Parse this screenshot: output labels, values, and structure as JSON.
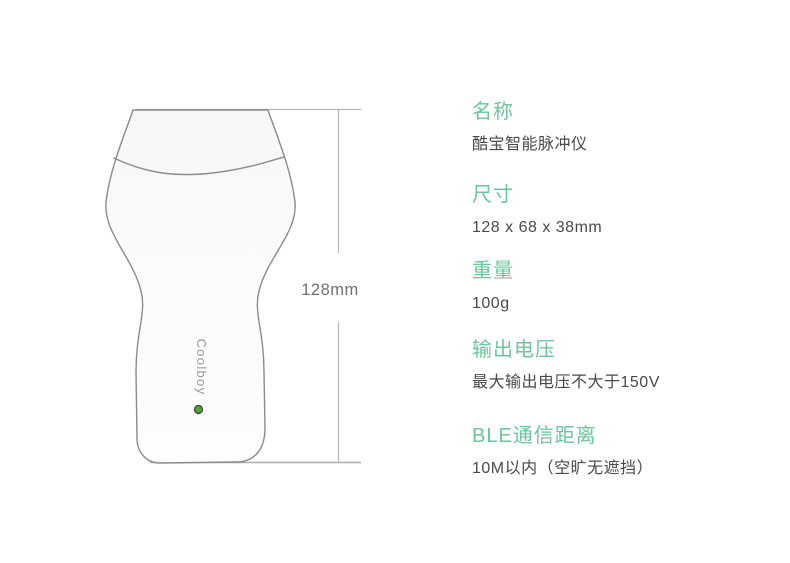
{
  "diagram": {
    "brand_label": "Coolboy",
    "dimension_label": "128mm",
    "led_indicator_color": "#55a33e"
  },
  "colors": {
    "accent_green": "#6ec49c",
    "text_dark": "#4a4a4a",
    "outline_gray": "#8b8b8b",
    "dimension_line_gray": "#b3b3b3"
  },
  "specs": [
    {
      "label": "名称",
      "value": "酷宝智能脉冲仪"
    },
    {
      "label": "尺寸",
      "value": "128 x 68 x 38mm"
    },
    {
      "label": "重量",
      "value": "100g"
    },
    {
      "label": "输出电压",
      "value": "最大输出电压不大于150V"
    },
    {
      "label": "BLE通信距离",
      "value": "10M以内（空旷无遮挡）"
    }
  ]
}
